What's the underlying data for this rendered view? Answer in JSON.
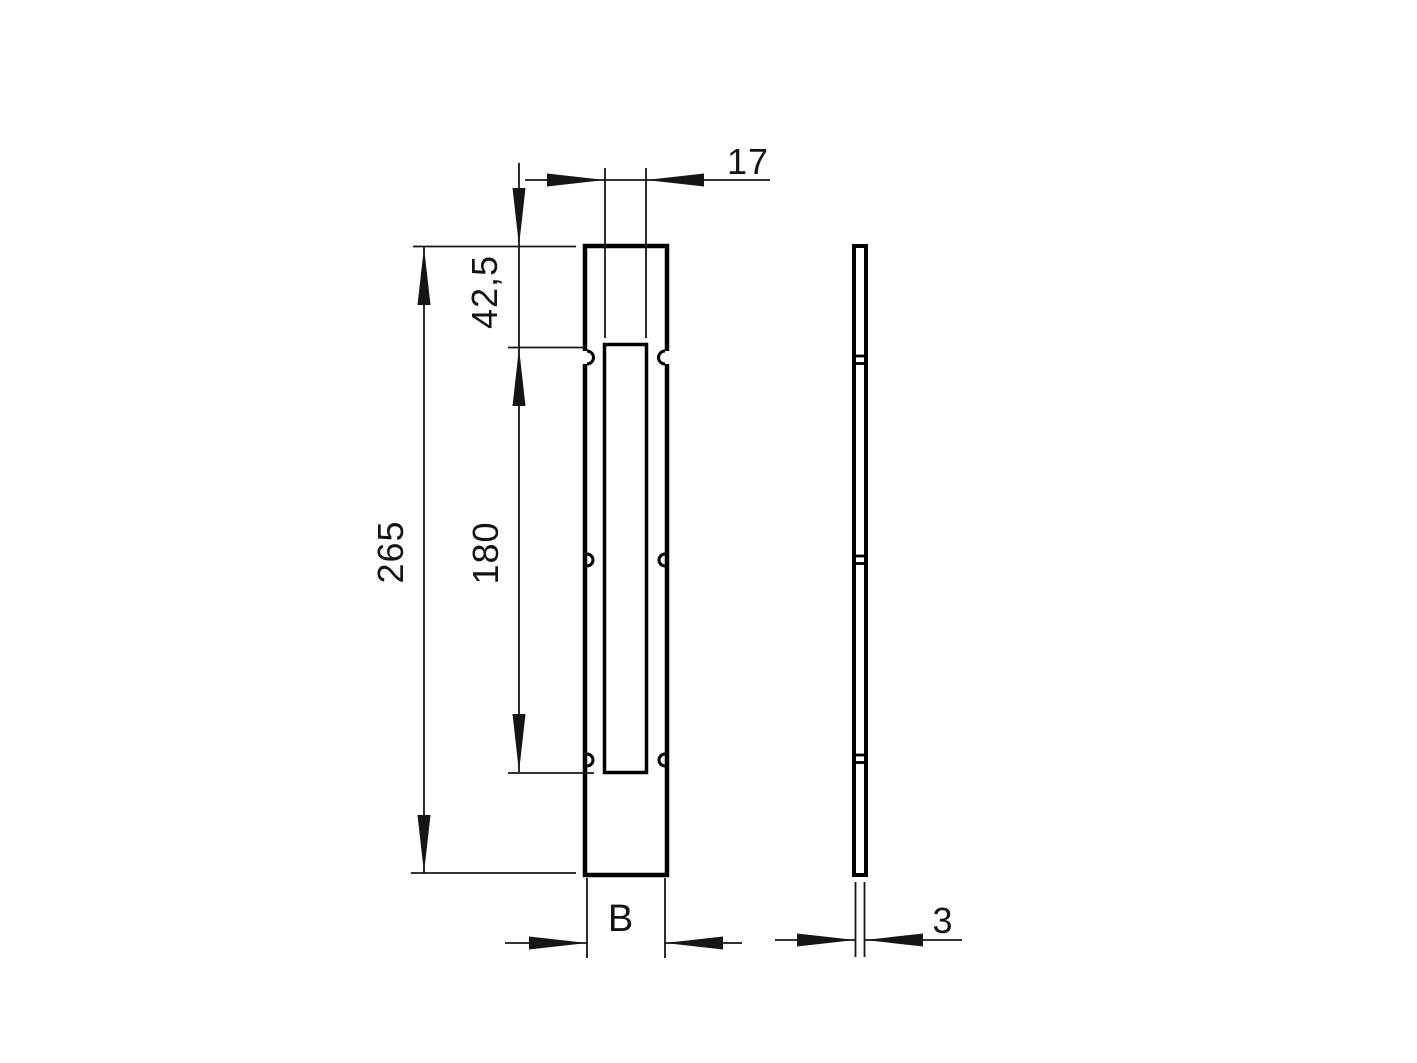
{
  "canvas": {
    "width": 1417,
    "height": 1063,
    "background": "#ffffff",
    "line_color": "#000000"
  },
  "drawing": {
    "kind": "technical-dimension-drawing",
    "views": {
      "front_view": "flat plate with central slot, edge notches top / middle / bottom",
      "side_view": "thin profile showing plate thickness"
    },
    "dimensions": {
      "slot_width": {
        "label": "17",
        "value": 17
      },
      "top_offset": {
        "label": "42,5",
        "value": 42.5
      },
      "overall_length": {
        "label": "265",
        "value": 265
      },
      "slot_length": {
        "label": "180",
        "value": 180
      },
      "plate_width": {
        "label": "B",
        "value": "B"
      },
      "thickness": {
        "label": "3",
        "value": 3
      }
    }
  }
}
